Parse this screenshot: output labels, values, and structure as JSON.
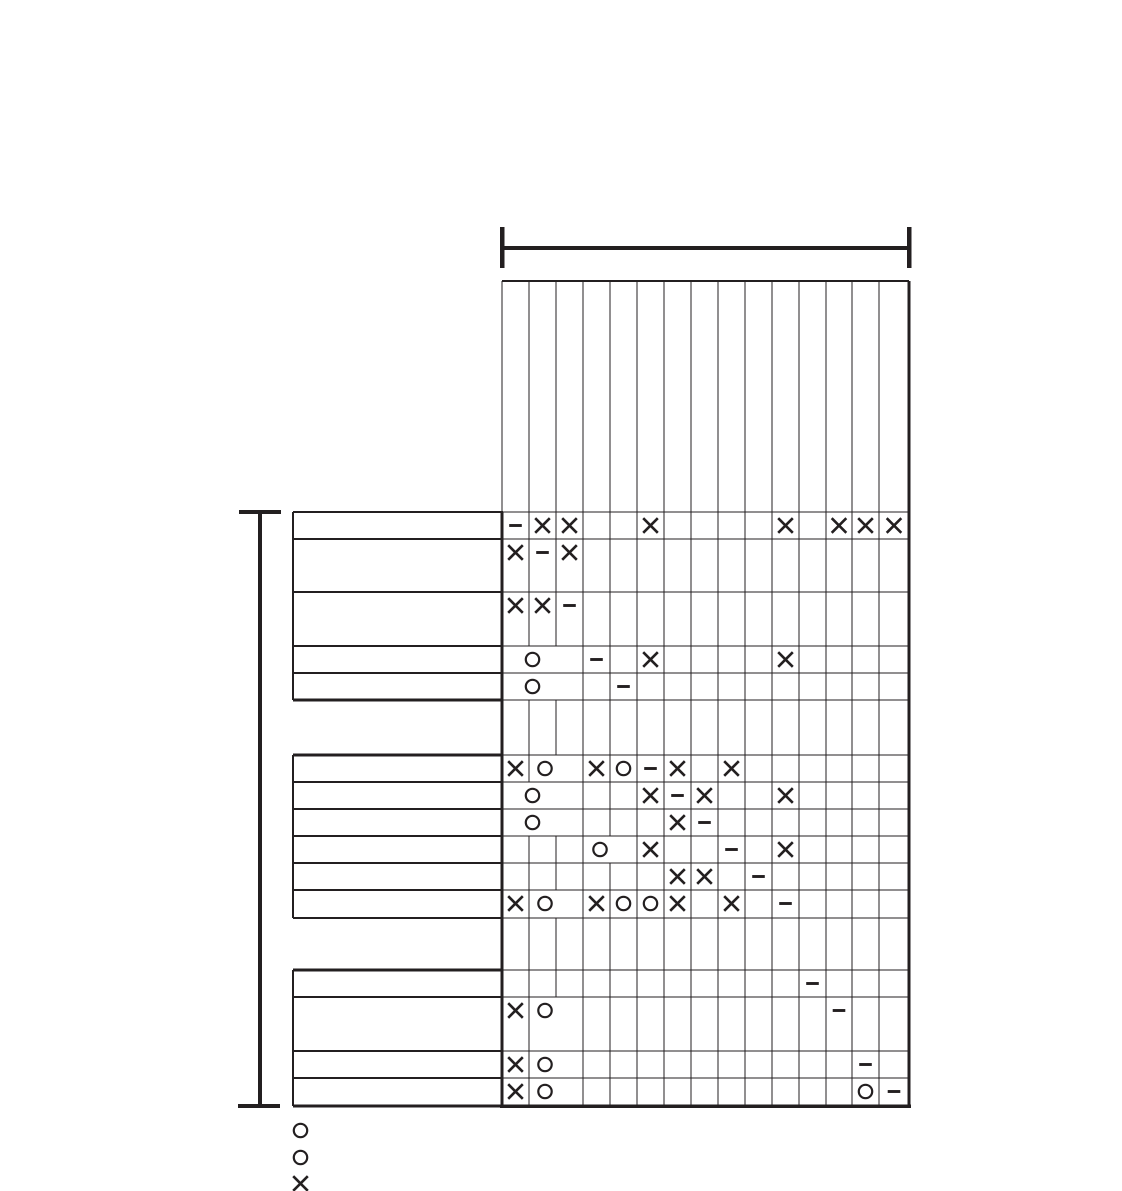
{
  "page": {
    "background_color": "#ffffff",
    "ink_color": "#231f20"
  },
  "matrix": {
    "type": "table",
    "description_symbols": {
      "x": "×",
      "circle": "○",
      "dash": "−"
    },
    "column_count": 15,
    "header_labels": [
      "",
      "",
      "",
      "",
      "",
      "",
      "",
      "",
      "",
      "",
      "",
      "",
      "",
      "",
      ""
    ],
    "row_labels": [
      "",
      "",
      "",
      "",
      "",
      "",
      "",
      "",
      "",
      "",
      "",
      "",
      "",
      "",
      ""
    ],
    "rows": [
      {
        "id": 1,
        "cells": {
          "1": "dash",
          "2": "x",
          "3": "x",
          "6": "x",
          "11": "x",
          "13": "x",
          "14": "x",
          "15": "x"
        }
      },
      {
        "id": 2,
        "cells": {
          "1": "x",
          "2": "dash",
          "3": "x"
        }
      },
      {
        "id": 3,
        "cells": {
          "1": "x",
          "2": "x",
          "3": "dash"
        }
      },
      {
        "id": 4,
        "merge": {
          "from": 1,
          "to": 3,
          "symbol": "circle"
        },
        "cells": {
          "4": "dash",
          "6": "x",
          "11": "x"
        }
      },
      {
        "id": 5,
        "merge": {
          "from": 1,
          "to": 3,
          "symbol": "circle"
        },
        "cells": {
          "5": "dash"
        }
      },
      {
        "id": 6,
        "merge": {
          "from": 2,
          "to": 3,
          "symbol": "circle"
        },
        "cells": {
          "1": "x",
          "4": "x",
          "5": "circle",
          "6": "dash",
          "7": "x",
          "9": "x"
        }
      },
      {
        "id": 7,
        "merge": {
          "from": 1,
          "to": 3,
          "symbol": "circle"
        },
        "cells": {
          "6": "x",
          "7": "dash",
          "8": "x",
          "11": "x"
        }
      },
      {
        "id": 8,
        "merge": {
          "from": 1,
          "to": 3,
          "symbol": "circle"
        },
        "cells": {
          "7": "x",
          "8": "dash"
        }
      },
      {
        "id": 9,
        "merge": {
          "from": 4,
          "to": 5,
          "symbol": "circle"
        },
        "cells": {
          "6": "x",
          "9": "dash",
          "11": "x"
        }
      },
      {
        "id": 10,
        "cells": {
          "7": "x",
          "8": "x",
          "10": "dash"
        }
      },
      {
        "id": 11,
        "merge": {
          "from": 2,
          "to": 3,
          "symbol": "circle"
        },
        "cells": {
          "1": "x",
          "4": "x",
          "5": "circle",
          "6": "circle",
          "7": "x",
          "9": "x",
          "11": "dash"
        }
      },
      {
        "id": 12,
        "cells": {
          "12": "dash"
        }
      },
      {
        "id": 13,
        "merge": {
          "from": 2,
          "to": 3,
          "symbol": "circle"
        },
        "cells": {
          "1": "x",
          "13": "dash"
        }
      },
      {
        "id": 14,
        "merge": {
          "from": 2,
          "to": 3,
          "symbol": "circle"
        },
        "cells": {
          "1": "x",
          "14": "dash"
        }
      },
      {
        "id": 15,
        "merge": {
          "from": 2,
          "to": 3,
          "symbol": "circle"
        },
        "cells": {
          "1": "x",
          "14": "circle",
          "15": "dash"
        }
      }
    ],
    "legend": [
      {
        "symbol": "circle",
        "label": ""
      },
      {
        "symbol": "circle",
        "label": ""
      },
      {
        "symbol": "x",
        "label": ""
      }
    ]
  },
  "geometry": {
    "col_edges": [
      502,
      529,
      556,
      583,
      610,
      637,
      664,
      691,
      718,
      745,
      772,
      799,
      826,
      852,
      879,
      909
    ],
    "header_top": 281,
    "grid_bottom": 1106,
    "row_edge_groups": [
      [
        512,
        539,
        592,
        646,
        673,
        700
      ],
      [
        755,
        782,
        809,
        836,
        863,
        890,
        918
      ],
      [
        970,
        997,
        1051,
        1078,
        1106
      ]
    ],
    "label_left": 293,
    "label_right": 503,
    "label_group_borders": [
      {
        "top_thick": false,
        "bottom_thick": true
      },
      {
        "top_thick": true,
        "bottom_thick": false
      },
      {
        "top_thick": true,
        "bottom_thick": true
      }
    ],
    "merge_circle_cx": {
      "1-3": 532.5,
      "2-3": 545,
      "4-5": 600
    },
    "symbol_offset_y": 13.5,
    "top_bracket": {
      "bar_y": 248,
      "x1": 502,
      "x2": 909,
      "tick_y1": 227,
      "tick_y2": 268
    },
    "left_bracket": {
      "x": 260,
      "y1": 512,
      "y2": 1106,
      "tick_x1": 239,
      "tick_x2": 281
    },
    "legend_pos": {
      "x": 300.5,
      "ys": [
        1130.5,
        1157.5,
        1183.5
      ]
    }
  }
}
